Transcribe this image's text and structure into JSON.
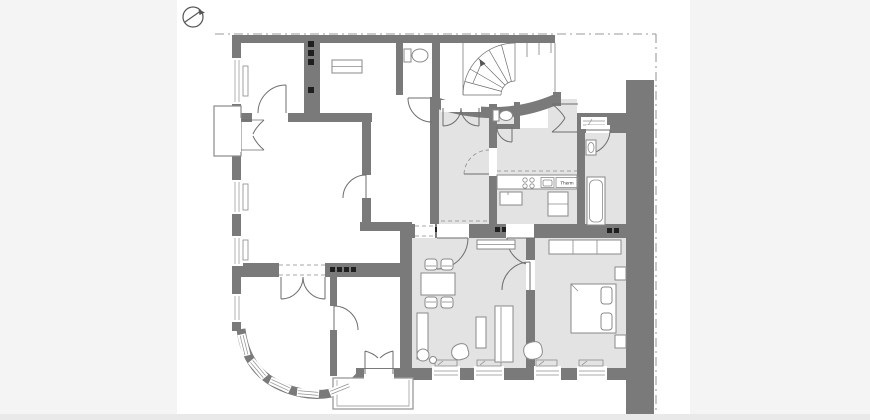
{
  "page": {
    "kind": "architectural-floor-plan"
  },
  "labels": {
    "therm": "Therm"
  },
  "colors": {
    "canvas_bg": "#f4f4f4",
    "sheet_bg": "#ffffff",
    "wall": "#7a7a7a",
    "room_shade": "#e3e3e3",
    "line": "#6e6e6e",
    "furniture_line": "#8a8a8a",
    "boundary": "#9a9a9a",
    "flue": "#1f1f1f",
    "bottom_strip": "#e9e9e9"
  },
  "icons": [
    "north-arrow-icon",
    "spiral-staircase-icon",
    "toilet-icon",
    "bathtub-icon",
    "washbasin-icon",
    "stove-burners-icon",
    "kitchen-sink-icon",
    "water-heater-icon",
    "double-bed-icon",
    "nightstand-icon",
    "wardrobe-icon",
    "sofa-icon",
    "armchair-icon",
    "dining-table-icon",
    "chair-icon",
    "plant-icon",
    "window-icon",
    "radiator-icon",
    "door-swing-icon",
    "chimney-flue-icon"
  ],
  "rooms": [
    {
      "id": "hall",
      "shaded": true
    },
    {
      "id": "wc-small",
      "shaded": true
    },
    {
      "id": "entrance-hall",
      "shaded": true
    },
    {
      "id": "kitchen",
      "shaded": true
    },
    {
      "id": "bathroom",
      "shaded": true
    },
    {
      "id": "living-dining-room",
      "shaded": true
    },
    {
      "id": "bedroom",
      "shaded": true
    },
    {
      "id": "room-top-left",
      "shaded": false
    },
    {
      "id": "room-middle-left",
      "shaded": false
    },
    {
      "id": "bay-window-room",
      "shaded": false
    },
    {
      "id": "room-center",
      "shaded": false
    },
    {
      "id": "wc-center",
      "shaded": false
    },
    {
      "id": "terrace",
      "shaded": false
    },
    {
      "id": "stairwell",
      "shaded": false
    }
  ]
}
